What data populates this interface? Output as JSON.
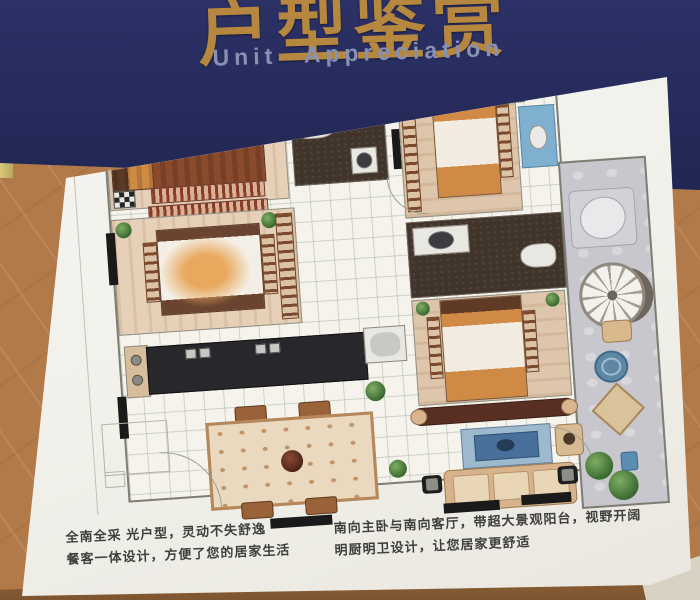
{
  "banner": {
    "title": "户型鉴赏",
    "subtitle": "Unit Appreciation",
    "colors": {
      "background": "#272c5e",
      "title": "#b6873e",
      "subtitle": "#8791b3"
    }
  },
  "board": {
    "background": "#f2f1ec"
  },
  "floor_plan": {
    "rooms": [
      "bedroom-top-left",
      "bathroom-top",
      "bedroom-top-right",
      "wash-area",
      "bedroom-middle-left",
      "bathroom-right",
      "bedroom-center",
      "kitchen",
      "dining-area",
      "living-room",
      "balcony"
    ],
    "colors": {
      "bedroom_floor": "#e6d0b8",
      "bathroom_floor": "#40342b",
      "tile_floor": "#f5f3ec",
      "balcony_floor": "#c8c7cd",
      "kitchen_counter": "#28282c",
      "bed_wood": "#5f3b26",
      "bedding_accent": "#cf8a45",
      "water_blue": "#7fb0cf",
      "plant_green": "#4c7a3d",
      "marker_black": "#1a1a1a"
    }
  },
  "descriptions": {
    "left": [
      "全南全采 光户型，灵动不失舒逸",
      "餐客一体设计，方便了您的居家生活"
    ],
    "right": [
      "南向主卧与南向客厅，带超大景观阳台，视野开阔",
      "明厨明卫设计，让您居家更舒适"
    ]
  },
  "environment": {
    "wall": "#b27a49",
    "wood_ledge": "#8d5e33",
    "trim": "#d9d2c2"
  }
}
